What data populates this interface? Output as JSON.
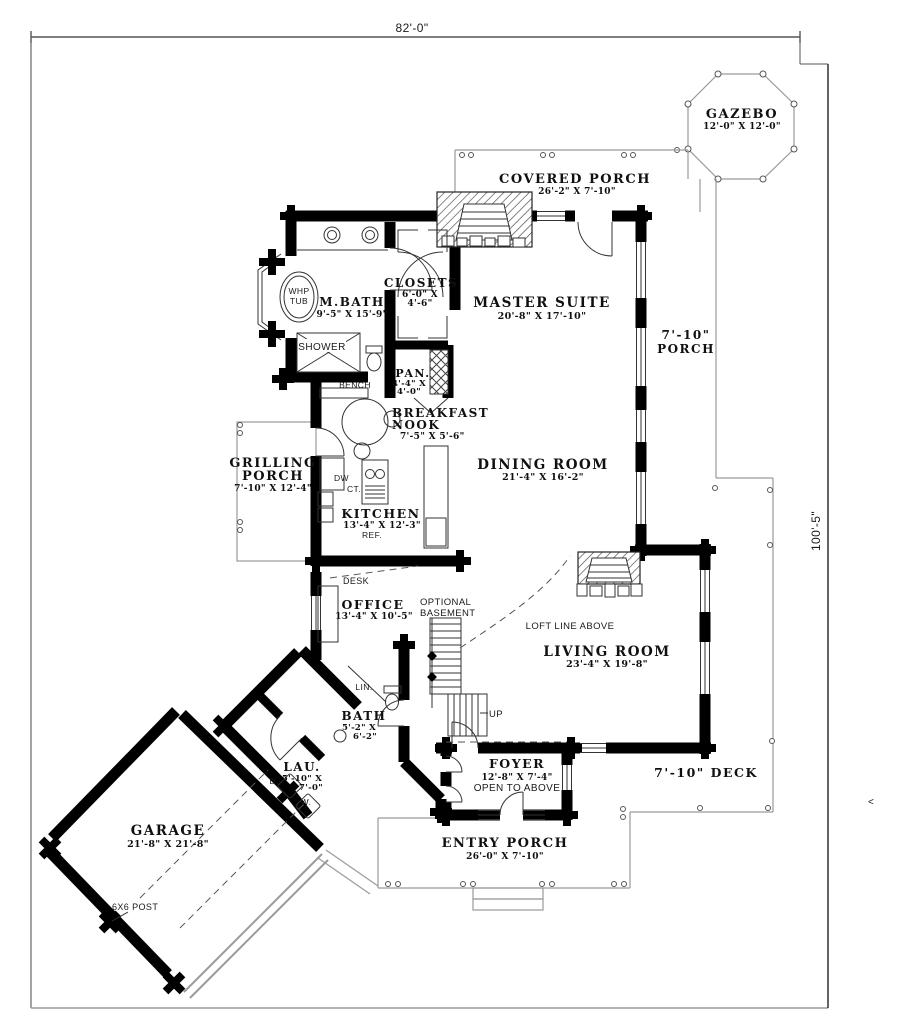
{
  "document": {
    "type": "first-floor-plan",
    "overall_width": "82'-0\"",
    "overall_depth": "100'-5\""
  },
  "rooms": {
    "master_suite": {
      "name": "MASTER SUITE",
      "dims": "20'-8\" X 17'-10\""
    },
    "m_bath": {
      "name": "M.BATH",
      "dims": "9'-5\" X 15'-9\""
    },
    "closets": {
      "name": "CLOSETS",
      "dims_line1": "6'-0\" X",
      "dims_line2": "4'-6\""
    },
    "pantry": {
      "name": "PAN.",
      "dims_line1": "4'-4\" X",
      "dims_line2": "4'-0\""
    },
    "breakfast_nook": {
      "name_line1": "BREAKFAST",
      "name_line2": "NOOK",
      "dims": "7'-5\" X 5'-6\""
    },
    "kitchen": {
      "name": "KITCHEN",
      "dims": "13'-4\" X 12'-3\""
    },
    "dining_room": {
      "name": "DINING ROOM",
      "dims": "21'-4\" X 16'-2\""
    },
    "office": {
      "name": "OFFICE",
      "dims": "13'-4\" X 10'-5\""
    },
    "living_room": {
      "name": "LIVING ROOM",
      "dims": "23'-4\" X 19'-8\""
    },
    "bath": {
      "name": "BATH",
      "dims_line1": "5'-2\" X",
      "dims_line2": "6'-2\""
    },
    "laundry": {
      "name": "LAU.",
      "dims_line1": "5'-10\" X",
      "dims_line2": "7'-0\""
    },
    "foyer": {
      "name": "FOYER",
      "dims": "12'-8\" X 7'-4\"",
      "note": "OPEN TO ABOVE"
    },
    "garage": {
      "name": "GARAGE",
      "dims": "21'-8\" X 21'-8\""
    }
  },
  "outdoor": {
    "gazebo": {
      "name": "GAZEBO",
      "dims": "12'-0\" X 12'-0\""
    },
    "covered_porch": {
      "name": "COVERED PORCH",
      "dims": "26'-2\" X 7'-10\""
    },
    "side_porch": {
      "line1": "7'-10\"",
      "line2": "PORCH"
    },
    "grilling_porch": {
      "line1": "GRILLING",
      "line2": "PORCH",
      "dims": "7'-10\" X 12'-4\""
    },
    "deck": {
      "name": "7'-10\" DECK"
    },
    "entry_porch": {
      "name": "ENTRY PORCH",
      "dims": "26'-0\" X 7'-10\""
    }
  },
  "fixtures": {
    "whirlpool_line1": "WHP",
    "whirlpool_line2": "TUB",
    "shower": "SHOWER",
    "bench": "BENCH",
    "desk": "DESK",
    "dishwasher": "DW",
    "cooktop": "CT.",
    "refrigerator": "REF.",
    "linen": "LIN.",
    "dryer": "D.",
    "washer": "W."
  },
  "annotations": {
    "optional_basement_line1": "OPTIONAL",
    "optional_basement_line2": "BASEMENT",
    "loft_line": "LOFT LINE ABOVE",
    "stairs_up": "UP",
    "post": "6X6 POST",
    "side_arrow": "<"
  },
  "colors": {
    "wall": "#000000",
    "thin_line": "#333333",
    "porch_line": "#9a9a9a",
    "background": "#ffffff"
  }
}
